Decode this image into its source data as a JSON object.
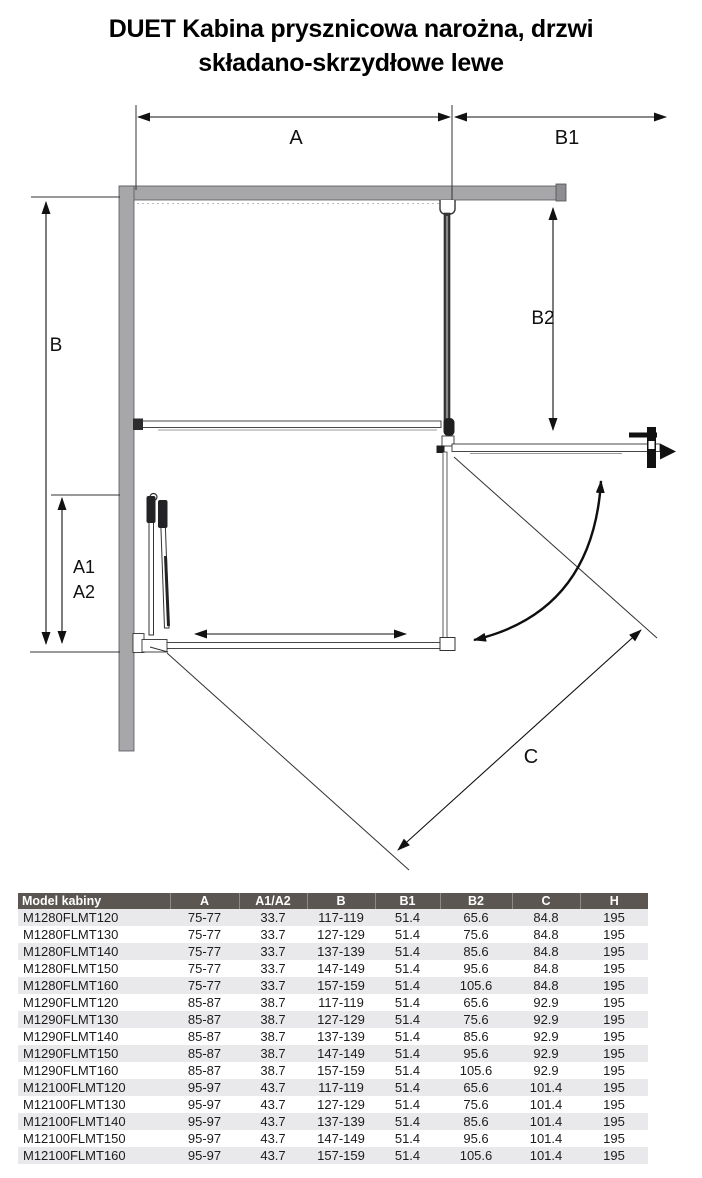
{
  "title": {
    "line1": "DUET Kabina prysznicowa narożna, drzwi",
    "line2": "składano-skrzydłowe lewe"
  },
  "diagram": {
    "dim_a": "A",
    "dim_b1": "B1",
    "dim_b": "B",
    "dim_b2": "B2",
    "dim_a1": "A1",
    "dim_a2": "A2",
    "dim_c": "C"
  },
  "colors": {
    "wall_fill": "#a7a7aa",
    "wall_edge": "#55555a",
    "header_bg": "#5b5651",
    "header_text": "#ffffff",
    "row_alt_bg": "#e9e9eb",
    "line": "#111111"
  },
  "table": {
    "columns": [
      "Model kabiny",
      "A",
      "A1/A2",
      "B",
      "B1",
      "B2",
      "C",
      "H"
    ],
    "rows": [
      [
        "M1280FLMT120",
        "75-77",
        "33.7",
        "117-119",
        "51.4",
        "65.6",
        "84.8",
        "195"
      ],
      [
        "M1280FLMT130",
        "75-77",
        "33.7",
        "127-129",
        "51.4",
        "75.6",
        "84.8",
        "195"
      ],
      [
        "M1280FLMT140",
        "75-77",
        "33.7",
        "137-139",
        "51.4",
        "85.6",
        "84.8",
        "195"
      ],
      [
        "M1280FLMT150",
        "75-77",
        "33.7",
        "147-149",
        "51.4",
        "95.6",
        "84.8",
        "195"
      ],
      [
        "M1280FLMT160",
        "75-77",
        "33.7",
        "157-159",
        "51.4",
        "105.6",
        "84.8",
        "195"
      ],
      [
        "M1290FLMT120",
        "85-87",
        "38.7",
        "117-119",
        "51.4",
        "65.6",
        "92.9",
        "195"
      ],
      [
        "M1290FLMT130",
        "85-87",
        "38.7",
        "127-129",
        "51.4",
        "75.6",
        "92.9",
        "195"
      ],
      [
        "M1290FLMT140",
        "85-87",
        "38.7",
        "137-139",
        "51.4",
        "85.6",
        "92.9",
        "195"
      ],
      [
        "M1290FLMT150",
        "85-87",
        "38.7",
        "147-149",
        "51.4",
        "95.6",
        "92.9",
        "195"
      ],
      [
        "M1290FLMT160",
        "85-87",
        "38.7",
        "157-159",
        "51.4",
        "105.6",
        "92.9",
        "195"
      ],
      [
        "M12100FLMT120",
        "95-97",
        "43.7",
        "117-119",
        "51.4",
        "65.6",
        "101.4",
        "195"
      ],
      [
        "M12100FLMT130",
        "95-97",
        "43.7",
        "127-129",
        "51.4",
        "75.6",
        "101.4",
        "195"
      ],
      [
        "M12100FLMT140",
        "95-97",
        "43.7",
        "137-139",
        "51.4",
        "85.6",
        "101.4",
        "195"
      ],
      [
        "M12100FLMT150",
        "95-97",
        "43.7",
        "147-149",
        "51.4",
        "95.6",
        "101.4",
        "195"
      ],
      [
        "M12100FLMT160",
        "95-97",
        "43.7",
        "157-159",
        "51.4",
        "105.6",
        "101.4",
        "195"
      ]
    ]
  }
}
